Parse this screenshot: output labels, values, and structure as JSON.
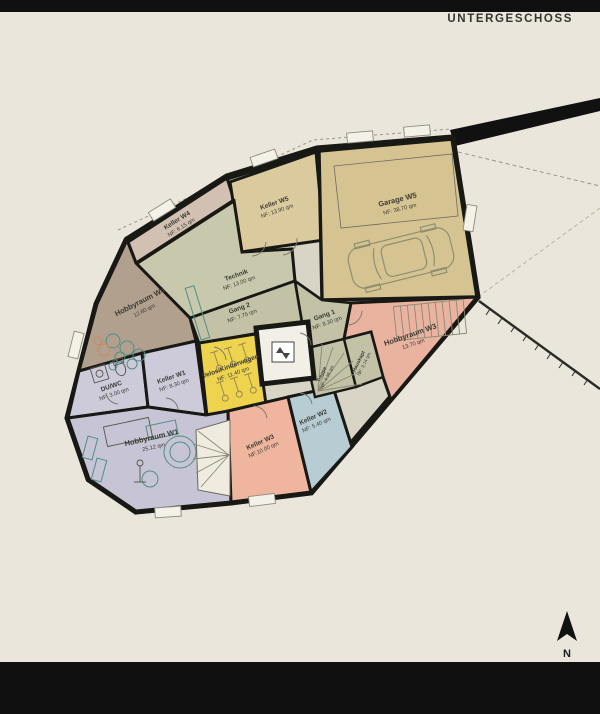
{
  "header": {
    "title": "UNTERGESCHOSS"
  },
  "colors": {
    "background": "#eae6db",
    "bars": "#101010",
    "walls": "#181815",
    "furniture_teal": "#4f8f85",
    "furniture_orange": "#c9885b"
  },
  "rooms": {
    "keller_w5": {
      "name": "Keller W5",
      "area": "NF: 13.90 qm",
      "color": "#dcca9f"
    },
    "garage_w5": {
      "name": "Garage W5",
      "area": "NF: 38.70 qm",
      "color": "#d6c392"
    },
    "keller_w4": {
      "name": "Keller W4",
      "area": "NF: 6.15 qm",
      "color": "#d2c0b2"
    },
    "technik": {
      "name": "Technik",
      "area": "NF: 13.00 qm",
      "color": "#c7c8ac"
    },
    "hobbyraum_w4": {
      "name": "Hobbyraum W4",
      "area": "12.80 qm",
      "color": "#b2a08f"
    },
    "gang_2": {
      "name": "Gang 2",
      "area": "NF: 7.75 qm",
      "color": "#c3c2a7"
    },
    "gang_1": {
      "name": "Gang 1",
      "area": "NF: 8.30 qm",
      "color": "#c3c2a7"
    },
    "velos": {
      "name": "Velos/Kinderwagen",
      "area": "NF: 11.40 qm",
      "color": "#eed34f"
    },
    "du_wc": {
      "name": "DU/WC",
      "area": "NF: 3.00 qm",
      "color": "#cdcad9"
    },
    "keller_w1": {
      "name": "Keller W1",
      "area": "NF: 8.30 qm",
      "color": "#cdcad9"
    },
    "hobbyraum_w1": {
      "name": "Hobbyraum W1",
      "area": "25.12 qm",
      "color": "#c7c4d5"
    },
    "keller_w3": {
      "name": "Keller W3",
      "area": "NF:10.00 qm",
      "color": "#efb59e"
    },
    "keller_w2": {
      "name": "Keller W2",
      "area": "NF: 5.40 qm",
      "color": "#b8cdd3"
    },
    "hobbyraum_w3": {
      "name": "Hobbyraum W3",
      "area": "13.70 qm",
      "color": "#e9b3a0"
    },
    "treppe": {
      "name": "Treppe",
      "area": "NF: 4.38 qm",
      "color": "#c3c2a7"
    },
    "hauskapt": {
      "name": "Hauskapt",
      "area": "NF: 3.14 qm",
      "color": "#c3c2a7"
    }
  },
  "compass": {
    "label": "N"
  }
}
